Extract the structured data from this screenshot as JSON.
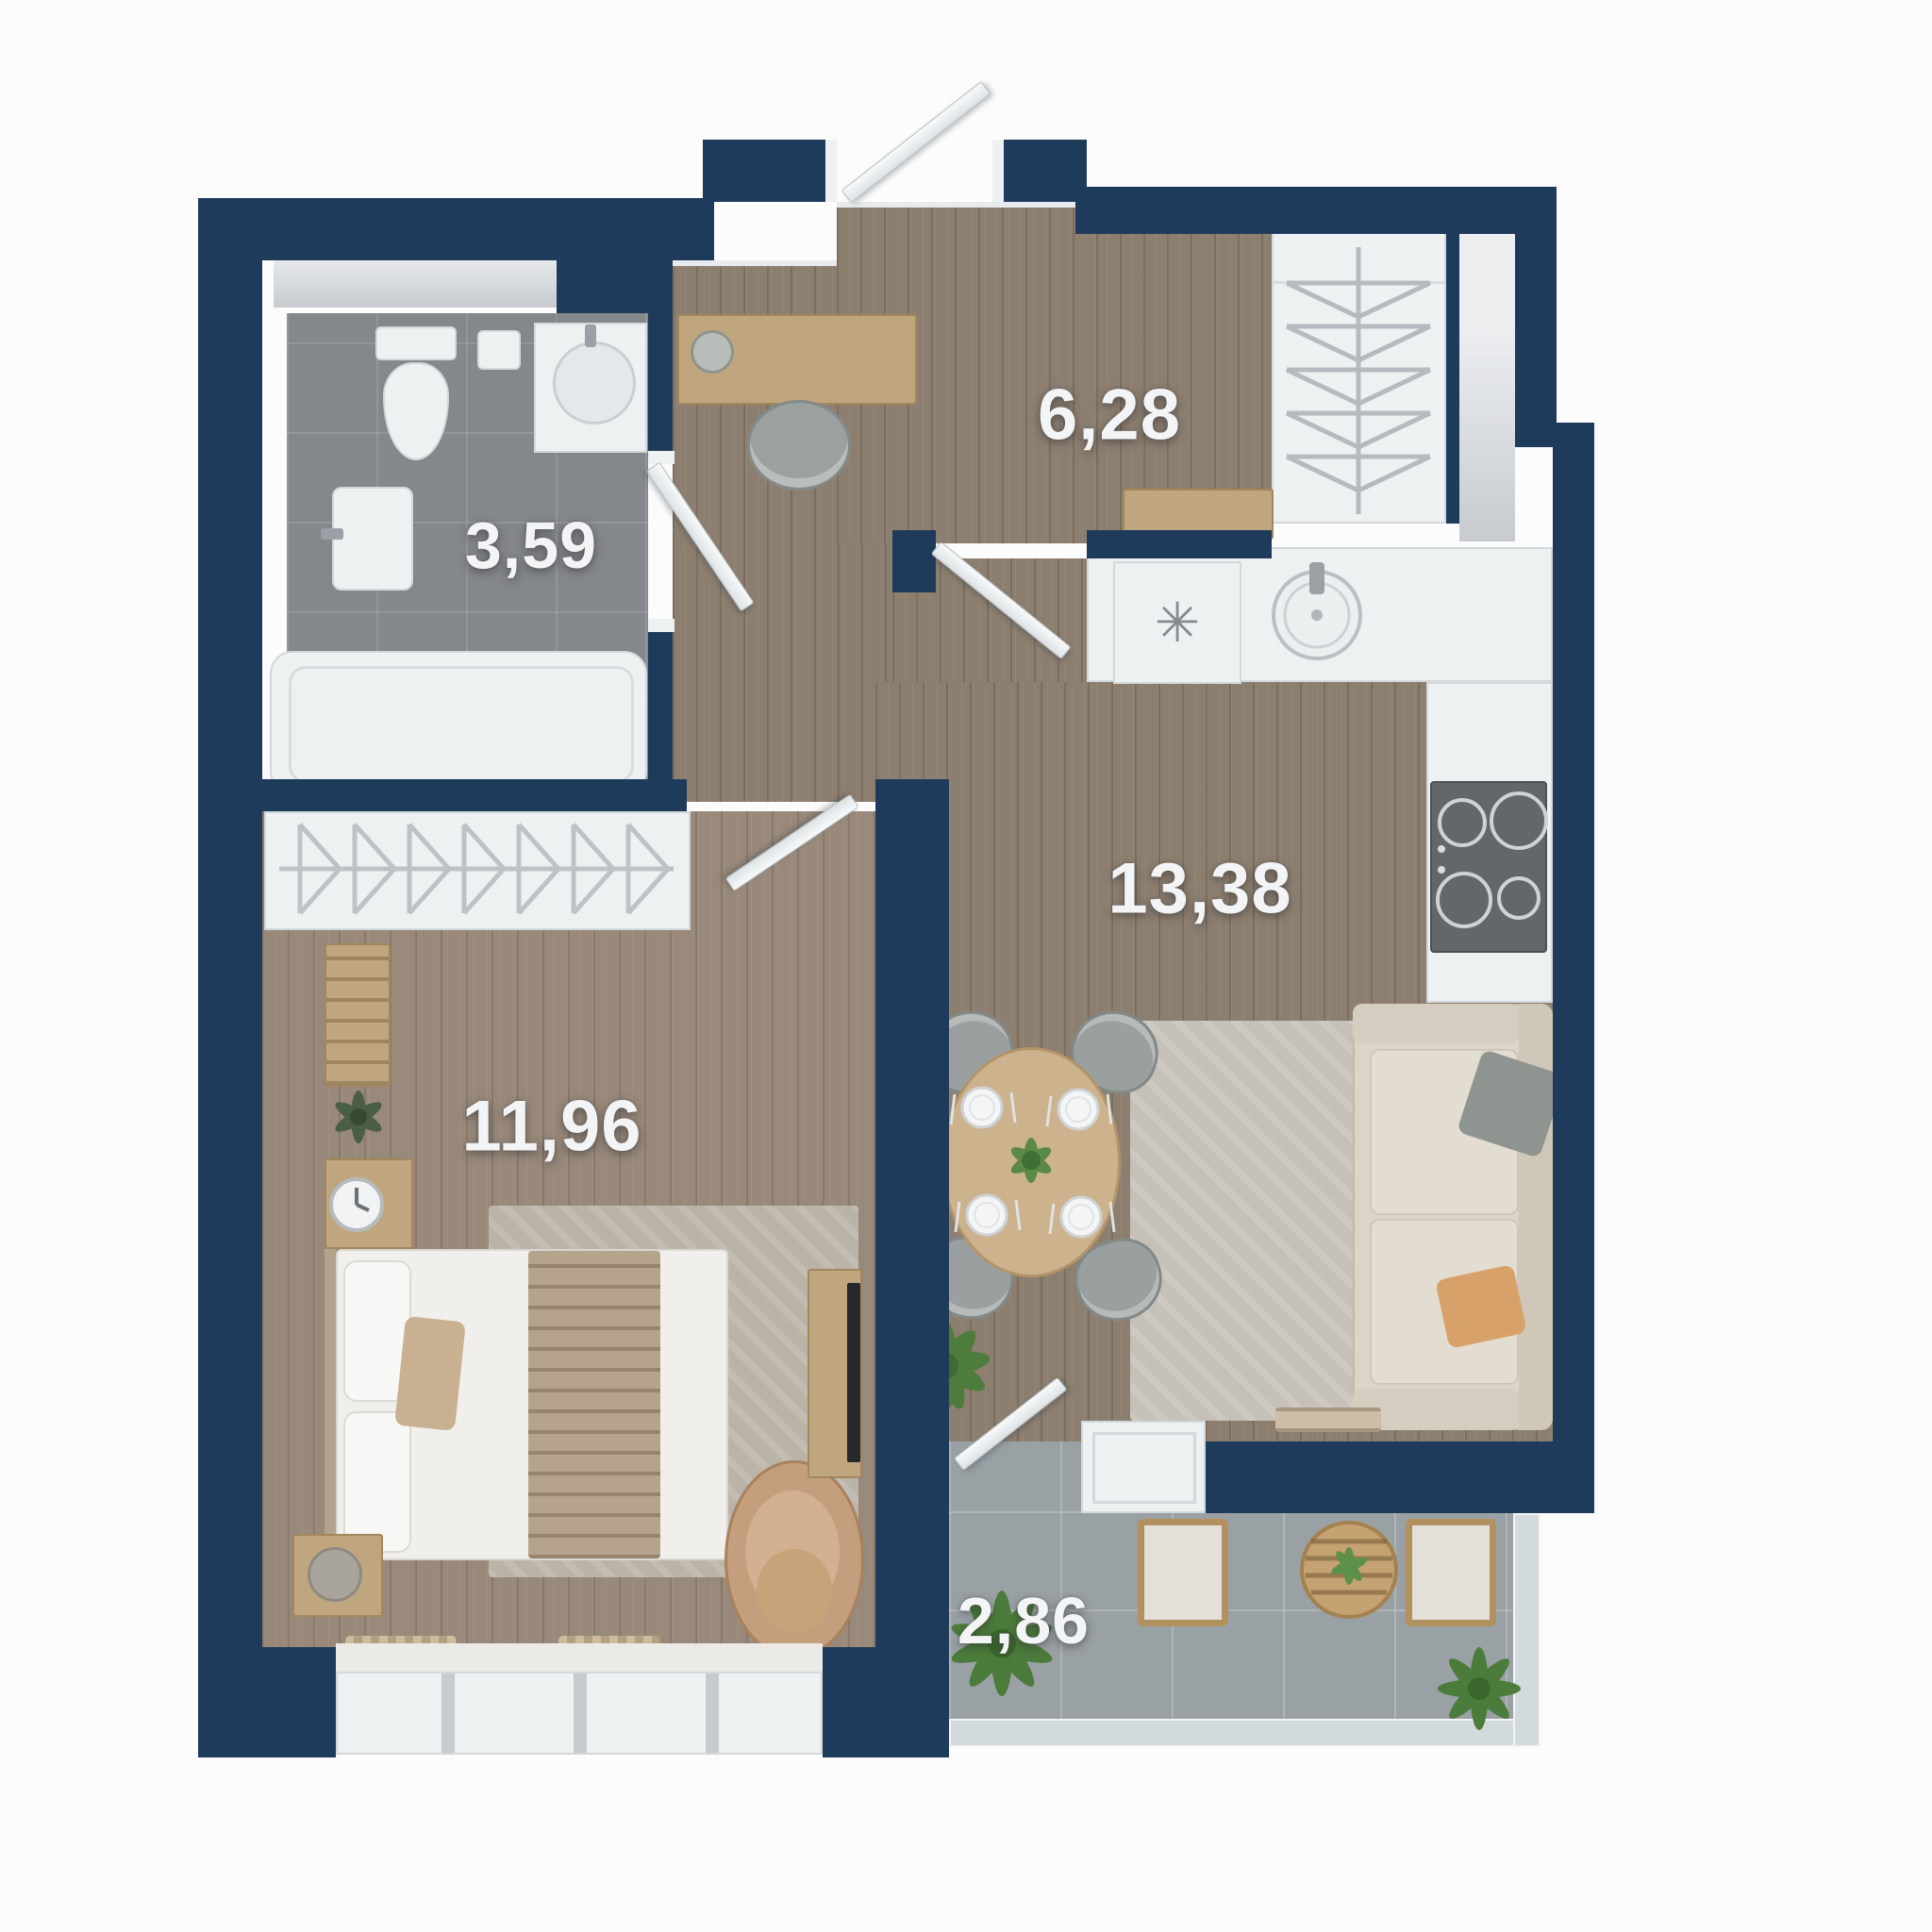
{
  "plan": {
    "type": "apartment-floor-plan",
    "rooms": {
      "bathroom": {
        "label": "3,59"
      },
      "hallway": {
        "label": "6,28"
      },
      "kitchen_living": {
        "label": "13,38"
      },
      "bedroom": {
        "label": "11,96"
      },
      "balcony": {
        "label": "2,86"
      }
    },
    "icons": {
      "fridge_snowflake": "✳"
    },
    "colors": {
      "wall": "#1f3b5c",
      "wood_floor": "#8d7f70",
      "bedroom_floor": "#98897a",
      "bathroom_tile": "#84878b",
      "balcony_tile": "#9aa1a5",
      "background": "#fcfcfc",
      "label_text": "#f3f4f5"
    }
  }
}
